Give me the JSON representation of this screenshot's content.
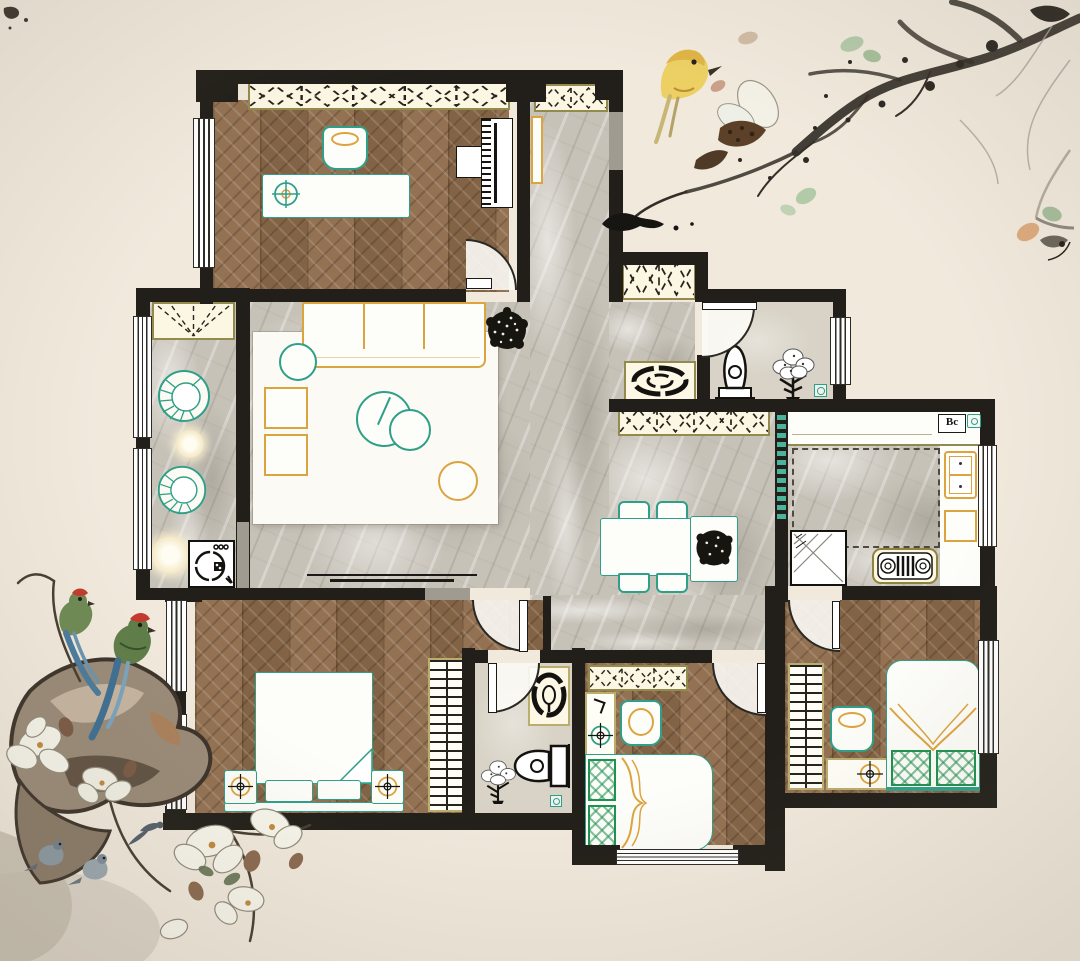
{
  "document": {
    "kind": "residential floor plan rendering",
    "style": "top-down interior plan decorated with Chinese ink-wash painting motifs",
    "background_color": "#f0e9dc"
  },
  "palette": {
    "wall": "#221f1a",
    "wood_floor": "#8d6a4a",
    "marble_floor": "#c7c2b8",
    "bath_tile": "#d8d3c6",
    "cabinet_cream": "#fcf7e2",
    "cabinet_border_olive": "#938b4e",
    "furniture_teal": "#2f9f88",
    "furniture_orange": "#dca43f",
    "plaid_green": "#1f9150"
  },
  "labels": {
    "kitchen_water_heater": "Bc"
  },
  "rooms": [
    {
      "id": "study-bedroom",
      "floor": "wood-herringbone",
      "furniture": [
        "built-in-wardrobe",
        "desk",
        "office-chair",
        "ceiling-lamp",
        "piano",
        "piano-bench",
        "swing-door"
      ]
    },
    {
      "id": "entry-hall",
      "floor": "marble",
      "furniture": [
        "shoe-cabinet",
        "console-table",
        "front-door"
      ]
    },
    {
      "id": "living-room",
      "floor": "marble",
      "furniture": [
        "area-rug",
        "three-seat-sofa",
        "round-cushion",
        "side-table",
        "side-table",
        "round-coffee-tables",
        "ottoman",
        "potted-plant",
        "tv-bench"
      ]
    },
    {
      "id": "balcony",
      "floor": "marble",
      "furniture": [
        "curtain-box",
        "rattan-chair",
        "tea-table",
        "rattan-chair",
        "floor-lamp",
        "washing-machine"
      ]
    },
    {
      "id": "hall-bathroom",
      "floor": "tile",
      "furniture": [
        "hall-cabinet",
        "bath-mat",
        "toilet",
        "potted-plant",
        "floor-drain",
        "swing-door"
      ]
    },
    {
      "id": "kitchen",
      "floor": "marble",
      "furniture": [
        "counter-run",
        "water-heater",
        "double-basin-sink",
        "counter-block",
        "gas-stove",
        "refrigerator",
        "sliding-glass-door"
      ]
    },
    {
      "id": "dining-room",
      "floor": "marble",
      "furniture": [
        "storage-cabinet",
        "dining-table",
        "dining-chair",
        "dining-chair",
        "dining-chair",
        "dining-chair",
        "plant-stand"
      ]
    },
    {
      "id": "master-bedroom",
      "floor": "wood-herringbone",
      "furniture": [
        "double-bed",
        "nightstand",
        "nightstand",
        "bed-bench",
        "slatted-wardrobe",
        "swing-door",
        "bay-windows"
      ]
    },
    {
      "id": "inner-bathroom",
      "floor": "tile",
      "furniture": [
        "vanity-basin",
        "toilet",
        "potted-plant",
        "floor-drain",
        "swing-door"
      ]
    },
    {
      "id": "south-bedroom",
      "floor": "wood-herringbone",
      "furniture": [
        "wardrobe",
        "desk",
        "chair",
        "bed-with-plaid-pillows",
        "swing-door",
        "south-window"
      ]
    },
    {
      "id": "east-bedroom",
      "floor": "wood-herringbone",
      "furniture": [
        "slatted-wardrobe",
        "desk",
        "chair",
        "bed-with-plaid-pillows",
        "swing-door",
        "east-window"
      ]
    }
  ],
  "decorations": [
    {
      "id": "ink-branch-with-yellow-bird",
      "position": "top-right"
    },
    {
      "id": "magnolia-blossoms",
      "position": "top-right"
    },
    {
      "id": "rock-with-green-parrots",
      "position": "bottom-left"
    },
    {
      "id": "white-magnolia-cluster",
      "position": "bottom-left"
    },
    {
      "id": "small-grey-birds",
      "position": "bottom-left"
    },
    {
      "id": "leafy-twig",
      "position": "right-edge"
    }
  ]
}
